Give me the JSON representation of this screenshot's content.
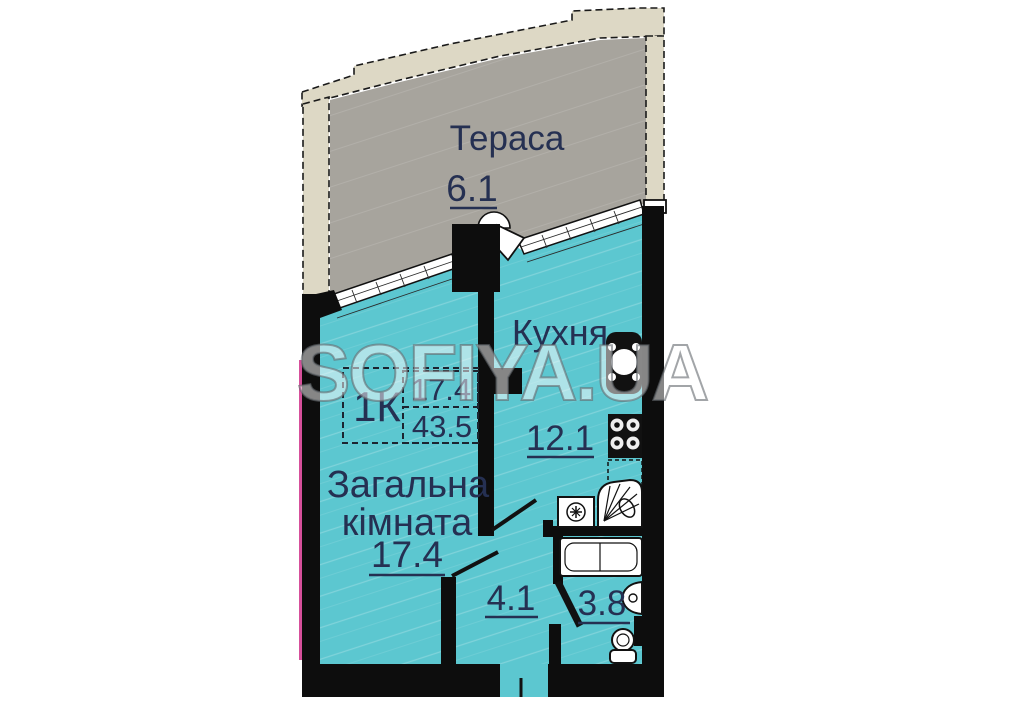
{
  "watermark": "SOFIYA.UA",
  "info_box": {
    "type_label": "1К",
    "living_area": "17.4",
    "total_area": "43.5"
  },
  "rooms": {
    "terrace": {
      "name": "Тераса",
      "area": "6.1"
    },
    "kitchen": {
      "name": "Кухня",
      "area": "12.1"
    },
    "living": {
      "name_line1": "Загальна",
      "name_line2": "кімната",
      "area": "17.4"
    },
    "hall": {
      "area": "4.1"
    },
    "bathroom": {
      "area": "3.8"
    }
  },
  "icons": [
    "window-icon",
    "door-arc-icon",
    "door-leaf-icon",
    "kitchen-sink-icon",
    "stove-icon",
    "counter-icon",
    "corner-sink-icon",
    "washing-machine-icon",
    "bathtub-icon",
    "washbasin-icon",
    "toilet-icon",
    "radiator-icon",
    "entrance-door-icon"
  ],
  "colors": {
    "room_fill": "#5cc7d0",
    "terrace_fill": "#a7a49d",
    "band_fill": "#ddd8c5",
    "wall": "#0d0d0d",
    "label": "#253052",
    "accent_pink": "#d6509b",
    "watermark_gray": "#6e7377"
  }
}
